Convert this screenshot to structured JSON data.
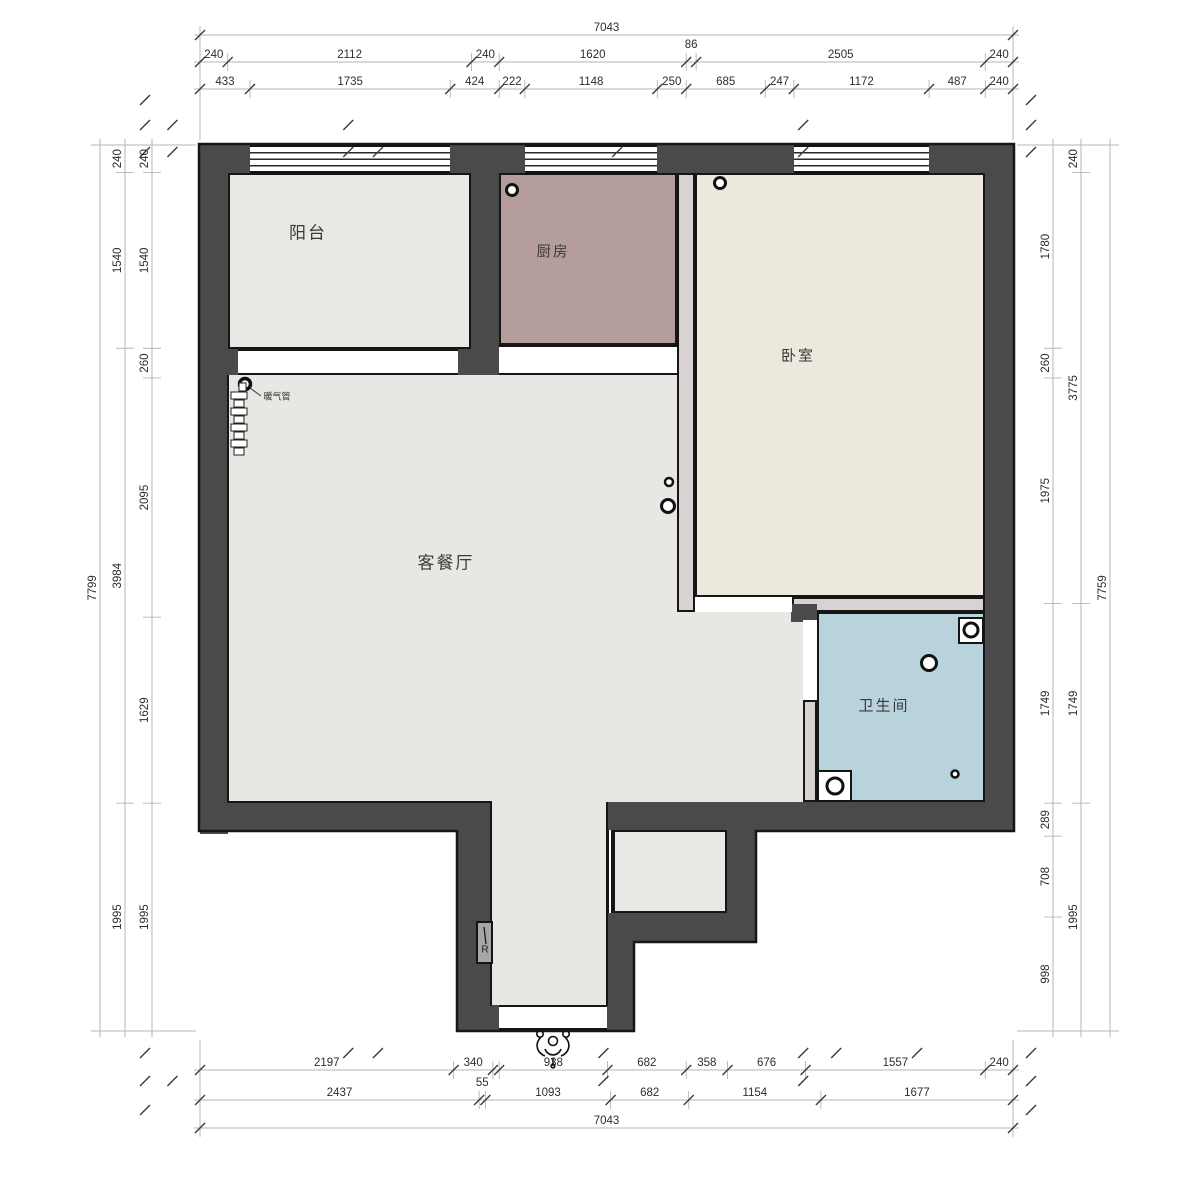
{
  "rooms": {
    "balcony": "阳台",
    "kitchen": "厨房",
    "bedroom": "卧室",
    "living_dining": "客餐厅",
    "bathroom": "卫生间",
    "heating_pipe": "暖气管",
    "riser_mark": "R"
  },
  "colors": {
    "wall": "#4a4a4a",
    "balcony_floor": "#e9e8e4",
    "kitchen_floor": "#b59d9b",
    "bedroom_floor": "#ece8dd",
    "living_floor": "#e8e7e3",
    "bathroom_floor": "#b9d3dc",
    "partition": "#d8d3d2",
    "outline": "#161616",
    "dimension_line": "#b5b5b5",
    "dimension_text": "#2d2d2d"
  },
  "dimensions": {
    "top": [
      {
        "values": [
          7043
        ]
      },
      {
        "values": [
          240,
          2112,
          240,
          1620,
          86,
          2505,
          240
        ]
      },
      {
        "values": [
          433,
          1735,
          424,
          222,
          1148,
          250,
          685,
          247,
          1172,
          487,
          240
        ]
      }
    ],
    "bottom": [
      {
        "values": [
          2197,
          340,
          55,
          938,
          682,
          358,
          676,
          1557,
          240
        ],
        "labels": [
          "2197",
          "340",
          "",
          "938",
          "682",
          "358",
          "676",
          "1557",
          "240"
        ]
      },
      {
        "values": [
          2437,
          55,
          1093,
          682,
          1154,
          1677
        ]
      },
      {
        "values": [
          7043
        ]
      }
    ],
    "left": [
      {
        "values": [
          7799
        ]
      },
      {
        "values": [
          240,
          1540,
          3984,
          1995
        ]
      },
      {
        "values": [
          240,
          1540,
          260,
          2095,
          1629,
          1995
        ]
      }
    ],
    "right": [
      {
        "values": [
          1780,
          260,
          1975,
          1749,
          289,
          708,
          998
        ]
      },
      {
        "values": [
          240,
          3775,
          1749,
          1995
        ]
      },
      {
        "values": [
          7759
        ]
      }
    ]
  }
}
